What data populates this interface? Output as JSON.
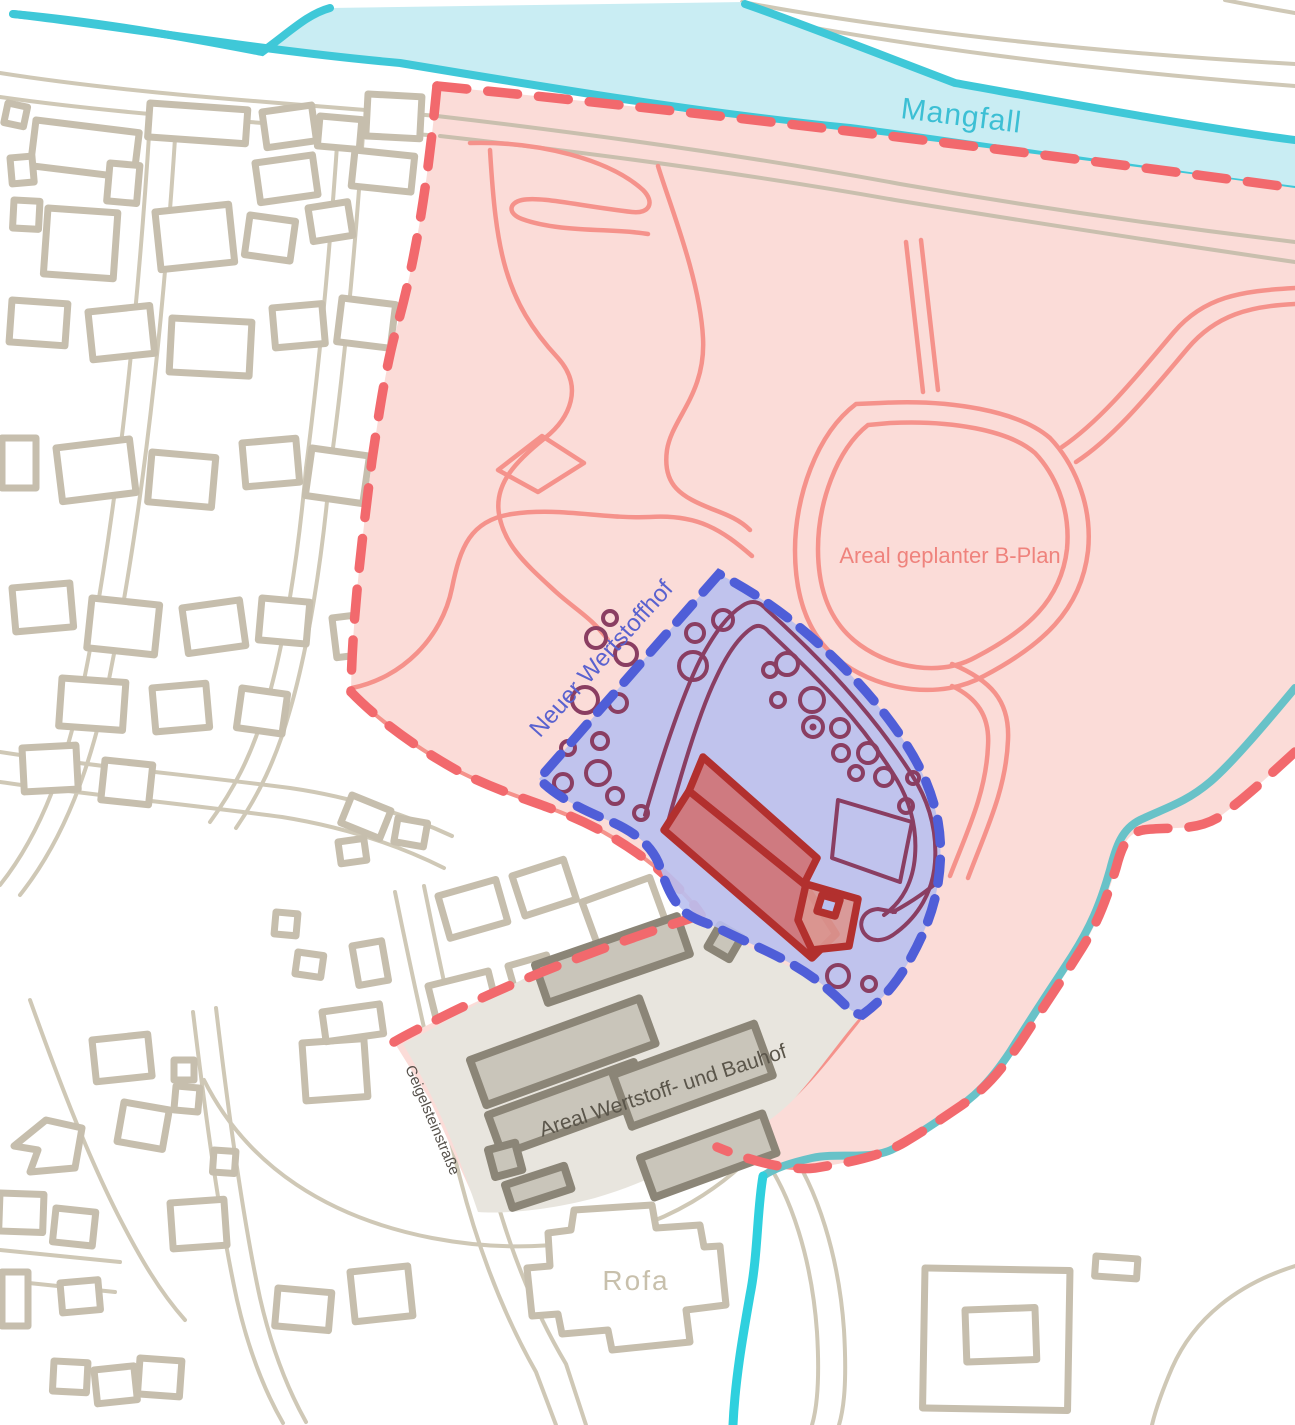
{
  "map": {
    "river": {
      "label": "Mangfall"
    },
    "bplan": {
      "label": "Areal geplanter B-Plan"
    },
    "wertstoffhof": {
      "label": "Neuer Wertstoffhof"
    },
    "bauhof": {
      "label": "Areal Wertstoff- und Bauhof"
    },
    "street": {
      "label": "Geigelsteinstraße"
    },
    "rofa": {
      "label": "Rofa"
    },
    "colors": {
      "river_fill": "#c9edf3",
      "river_bank": "#3fc8d8",
      "river_label": "#3cbfd4",
      "stream_bright": "#2fd0de",
      "stream_muted": "#68c2c8",
      "bplan_fill": "#fbdcd8",
      "bplan_dash": "#f2696d",
      "bplan_line": "#f5928b",
      "bplan_label": "#ef837d",
      "blue_fill": "#b9c0f0",
      "blue_dash": "#4f5ed8",
      "blue_detail": "#8a3e62",
      "blue_label": "#5a62cf",
      "building_stroke": "#b2302e",
      "building_fill": "#d07476",
      "building_annex": "#db9791",
      "gray_fill": "#e8e5de",
      "gray_bld_fill": "#c9c5ba",
      "gray_bld_stroke": "#8b8577",
      "gray_label": "#5a554a",
      "street_label": "#55504a",
      "bg_stroke": "#c6bead",
      "bg_street": "#cfc8b6",
      "bg_label": "#c8c0ac",
      "road_over_pink": "#c9bfae"
    }
  }
}
